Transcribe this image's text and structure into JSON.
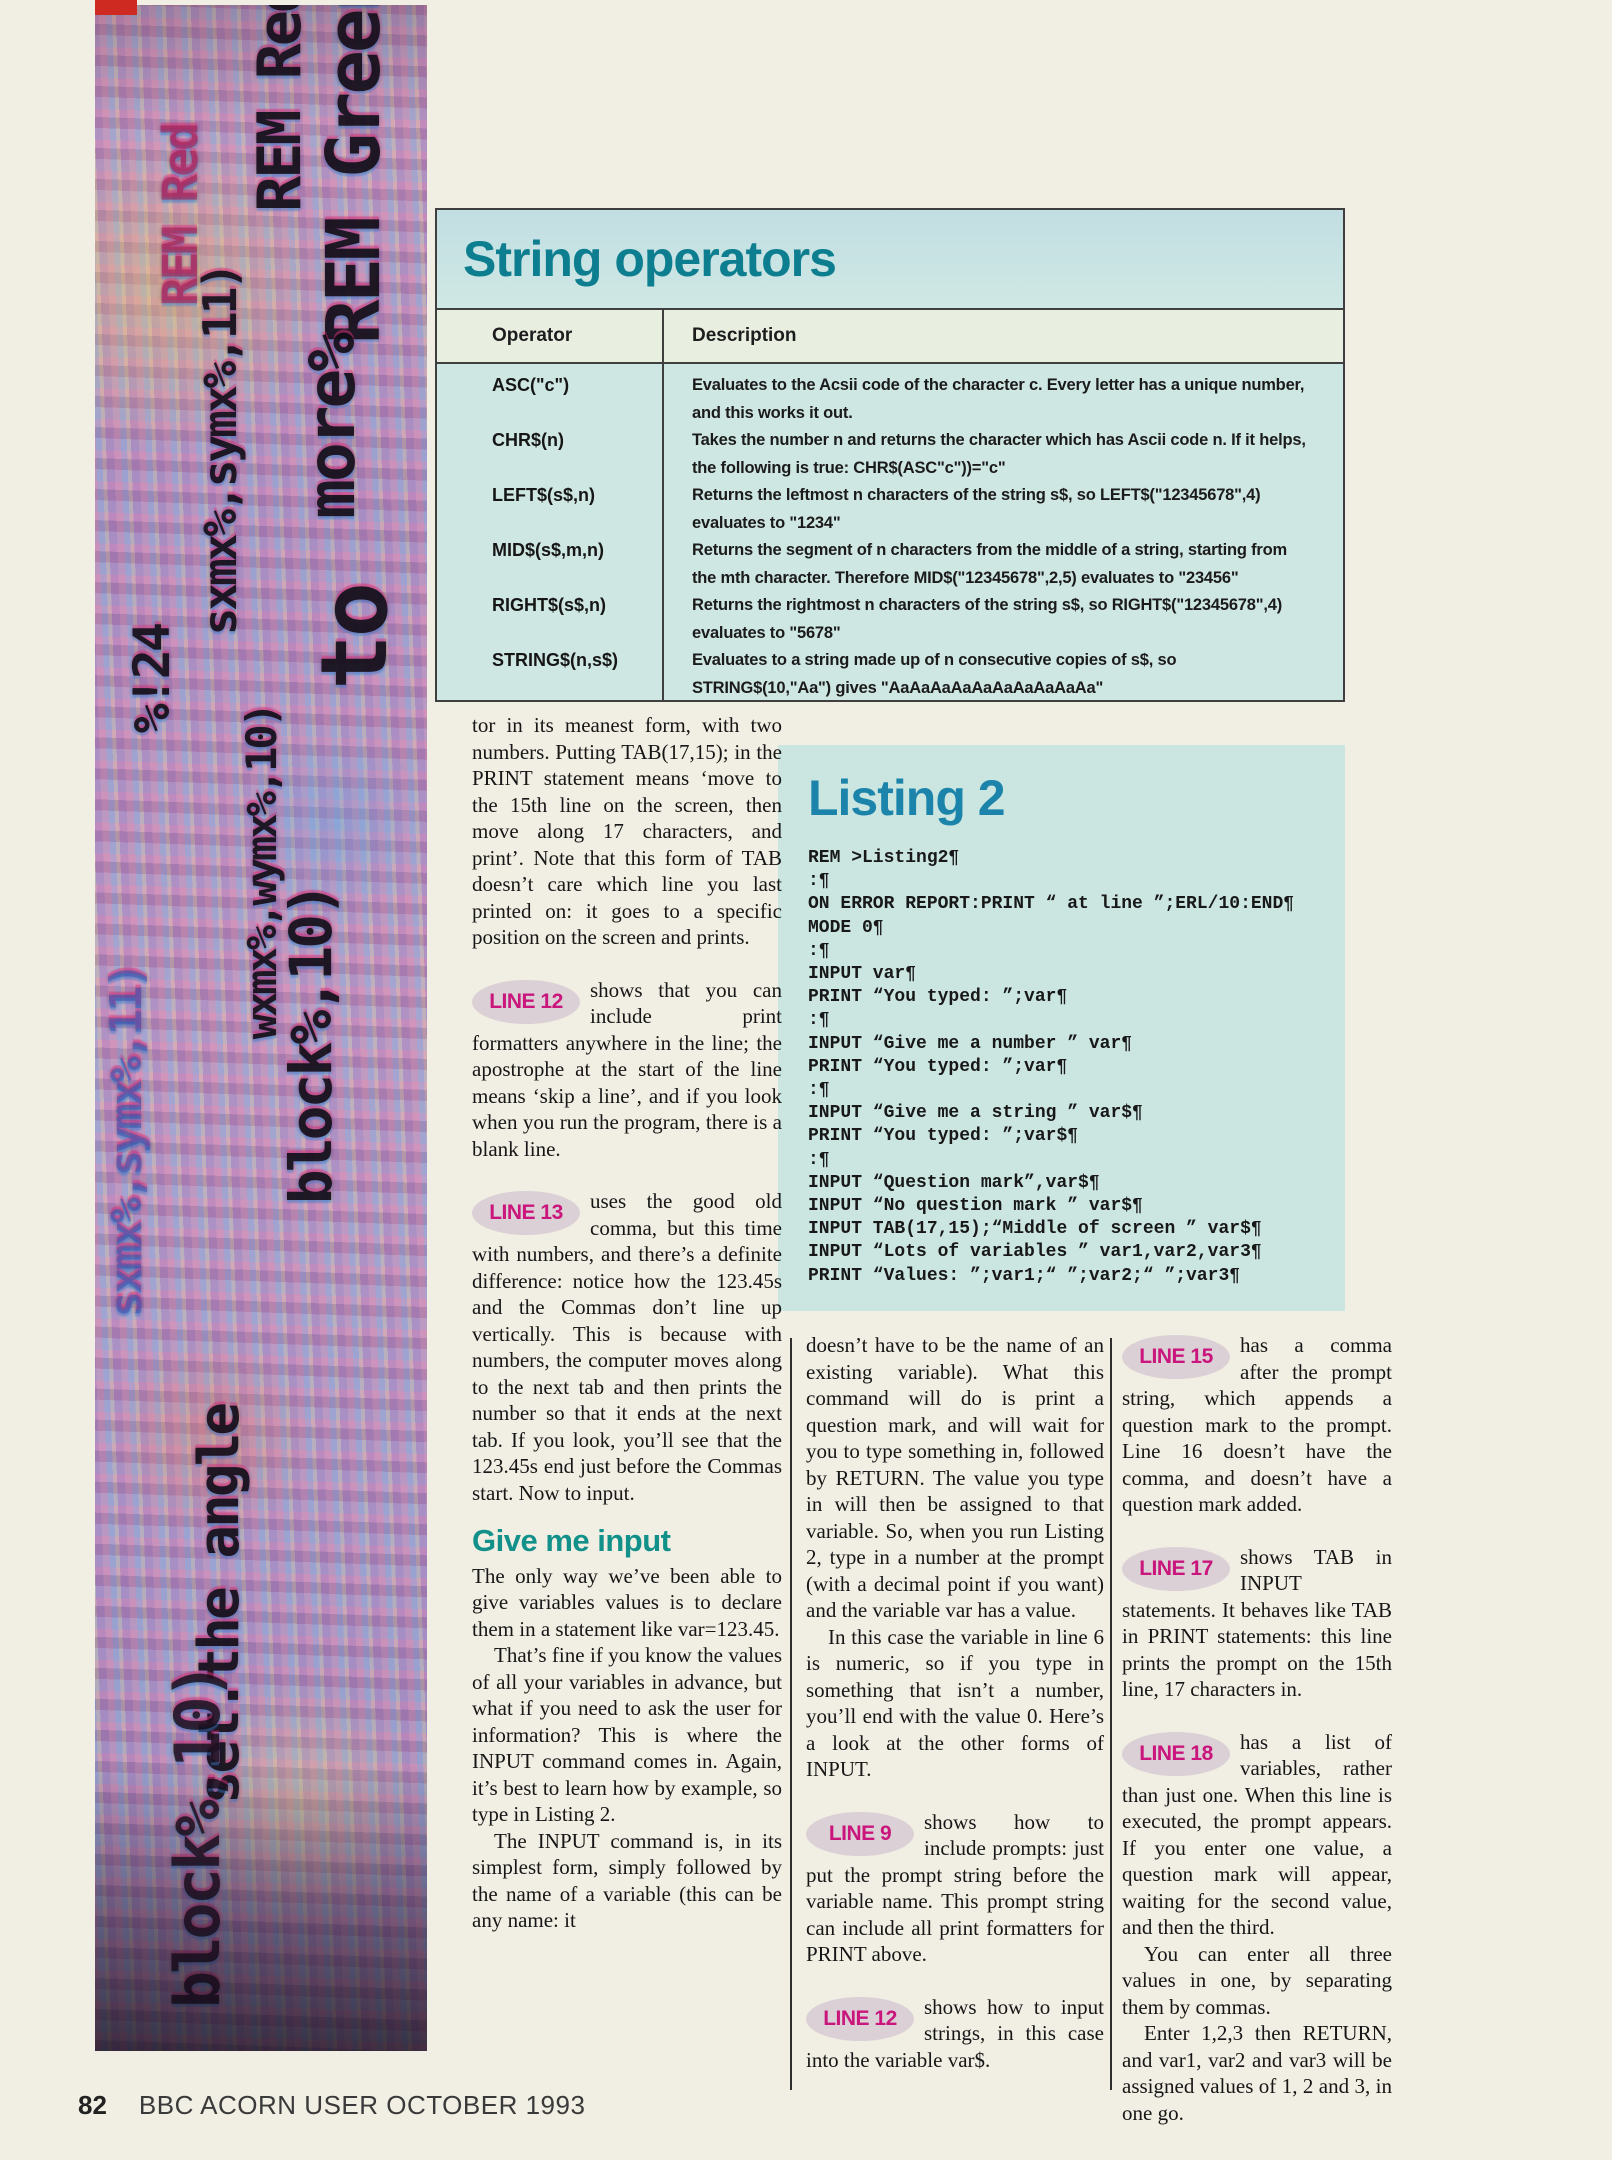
{
  "strip": {
    "fragments": [
      "REM Red",
      "REM Green",
      "more%",
      "to",
      "sxmx%,symx%,11)",
      "wxmx%,wymx%,10)",
      "block%,10)",
      "%!24",
      "set.the angle"
    ]
  },
  "operators_table": {
    "title": "String operators",
    "columns": {
      "operator": "Operator",
      "description": "Description"
    },
    "rows": [
      {
        "operator": "ASC(\"c\")",
        "description": "Evaluates to the Acsii code of the character c. Every letter has a unique number, and this works it out."
      },
      {
        "operator": "CHR$(n)",
        "description": "Takes the number n and returns the character which has Ascii code n. If it helps, the following is true: CHR$(ASC\"c\"))=\"c\""
      },
      {
        "operator": "LEFT$(s$,n)",
        "description": "Returns the leftmost n characters of the string s$, so LEFT$(\"12345678\",4) evaluates to \"1234\""
      },
      {
        "operator": "MID$(s$,m,n)",
        "description": "Returns the segment of n characters from the middle of a string, starting from the mth character. Therefore MID$(\"12345678\",2,5) evaluates to \"23456\""
      },
      {
        "operator": "RIGHT$(s$,n)",
        "description": "Returns the rightmost n characters of the string s$, so RIGHT$(\"12345678\",4) evaluates to \"5678\""
      },
      {
        "operator": "STRING$(n,s$)",
        "description": "Evaluates to a string made up of n consecutive copies of s$, so STRING$(10,\"Aa\") gives \"AaAaAaAaAaAaAaAaAaAa\""
      }
    ]
  },
  "listing": {
    "title": "Listing 2",
    "lines": [
      "REM >Listing2¶",
      ":¶",
      "ON ERROR REPORT:PRINT “ at line ”;ERL/10:END¶",
      "MODE 0¶",
      ":¶",
      "INPUT var¶",
      "PRINT “You typed: ”;var¶",
      ":¶",
      "INPUT “Give me a number ” var¶",
      "PRINT “You typed: ”;var¶",
      ":¶",
      "INPUT “Give me a string ” var$¶",
      "PRINT “You typed: ”;var$¶",
      ":¶",
      "INPUT “Question mark”,var$¶",
      "INPUT “No question mark ” var$¶",
      "INPUT TAB(17,15);“Middle of screen ” var$¶",
      "INPUT “Lots of variables ” var1,var2,var3¶",
      "PRINT “Values: ”;var1;“ ”;var2;“ ”;var3¶"
    ]
  },
  "badges": {
    "line9": "LINE 9",
    "line12": "LINE 12",
    "line13": "LINE 13",
    "line15": "LINE 15",
    "line17": "LINE 17",
    "line18": "LINE 18"
  },
  "article": {
    "col1": {
      "para1": "tor in its meanest form, with two numbers. Putting TAB(17,15); in the PRINT statement means ‘move to the 15th line on the screen, then move along 17 characters, and print’. Note that this form of TAB doesn’t care which line you last printed on: it goes to a specific position on the screen and prints.",
      "para2": "shows that you can include print formatters anywhere in the line; the apostrophe at the start of the line means ‘skip a line’, and if you look when you run the program, there is a blank line.",
      "para3": "uses the good old comma, but this time with numbers, and there’s a definite difference: notice how the 123.45s and the Commas don’t line up vertically. This is because with numbers, the computer moves along to the next tab and then prints the number so that it ends at the next tab. If you look, you’ll see that the 123.45s end just before the Commas start. Now to input.",
      "heading": "Give me input",
      "para4": "The only way we’ve been able to give variables values is to declare them in a statement like var=123.45.",
      "para5": "That’s fine if you know the values of all your variables in advance, but what if you need to ask the user for information? This is where the INPUT command comes in. Again, it’s best to learn how by example, so type in Listing 2.",
      "para6": "The INPUT command is, in its simplest form, simply followed by the name of a variable (this can be any name: it"
    },
    "col2": {
      "para1": "doesn’t have to be the name of an existing variable). What this command will do is print a question mark, and will wait for you to type something in, followed by RETURN. The value you type in will then be assigned to that variable. So, when you run Listing 2, type in a number at the prompt (with a decimal point if you want) and the variable var has a value.",
      "para2": "In this case the variable in line 6 is numeric, so if you type in something that isn’t a number, you’ll end with the value 0. Here’s a look at the other forms of INPUT.",
      "para3": "shows how to include prompts: just put the prompt string before the variable name. This prompt string can include all print formatters for PRINT above.",
      "para4": "shows how to input strings, in this case into the variable var$."
    },
    "col3": {
      "para1": "has a comma after the prompt string, which appends a question mark to the prompt. Line 16 doesn’t have the comma, and doesn’t have a question mark added.",
      "para2": "shows TAB in INPUT statements. It behaves like TAB in PRINT statements: this line prints the prompt on the 15th line, 17 characters in.",
      "para3": "has a list of variables, rather than just one. When this line is executed, the prompt appears. If you enter one value, a question mark will appear, waiting for the second value, and then the third.",
      "para4": "You can enter all three values in one, by separating them by commas.",
      "para5": "Enter 1,2,3 then RETURN, and var1, var2 and var3 will be assigned values of 1, 2 and 3, in one go."
    }
  },
  "footer": {
    "page_number": "82",
    "magazine": "BBC ACORN USER OCTOBER 1993"
  }
}
